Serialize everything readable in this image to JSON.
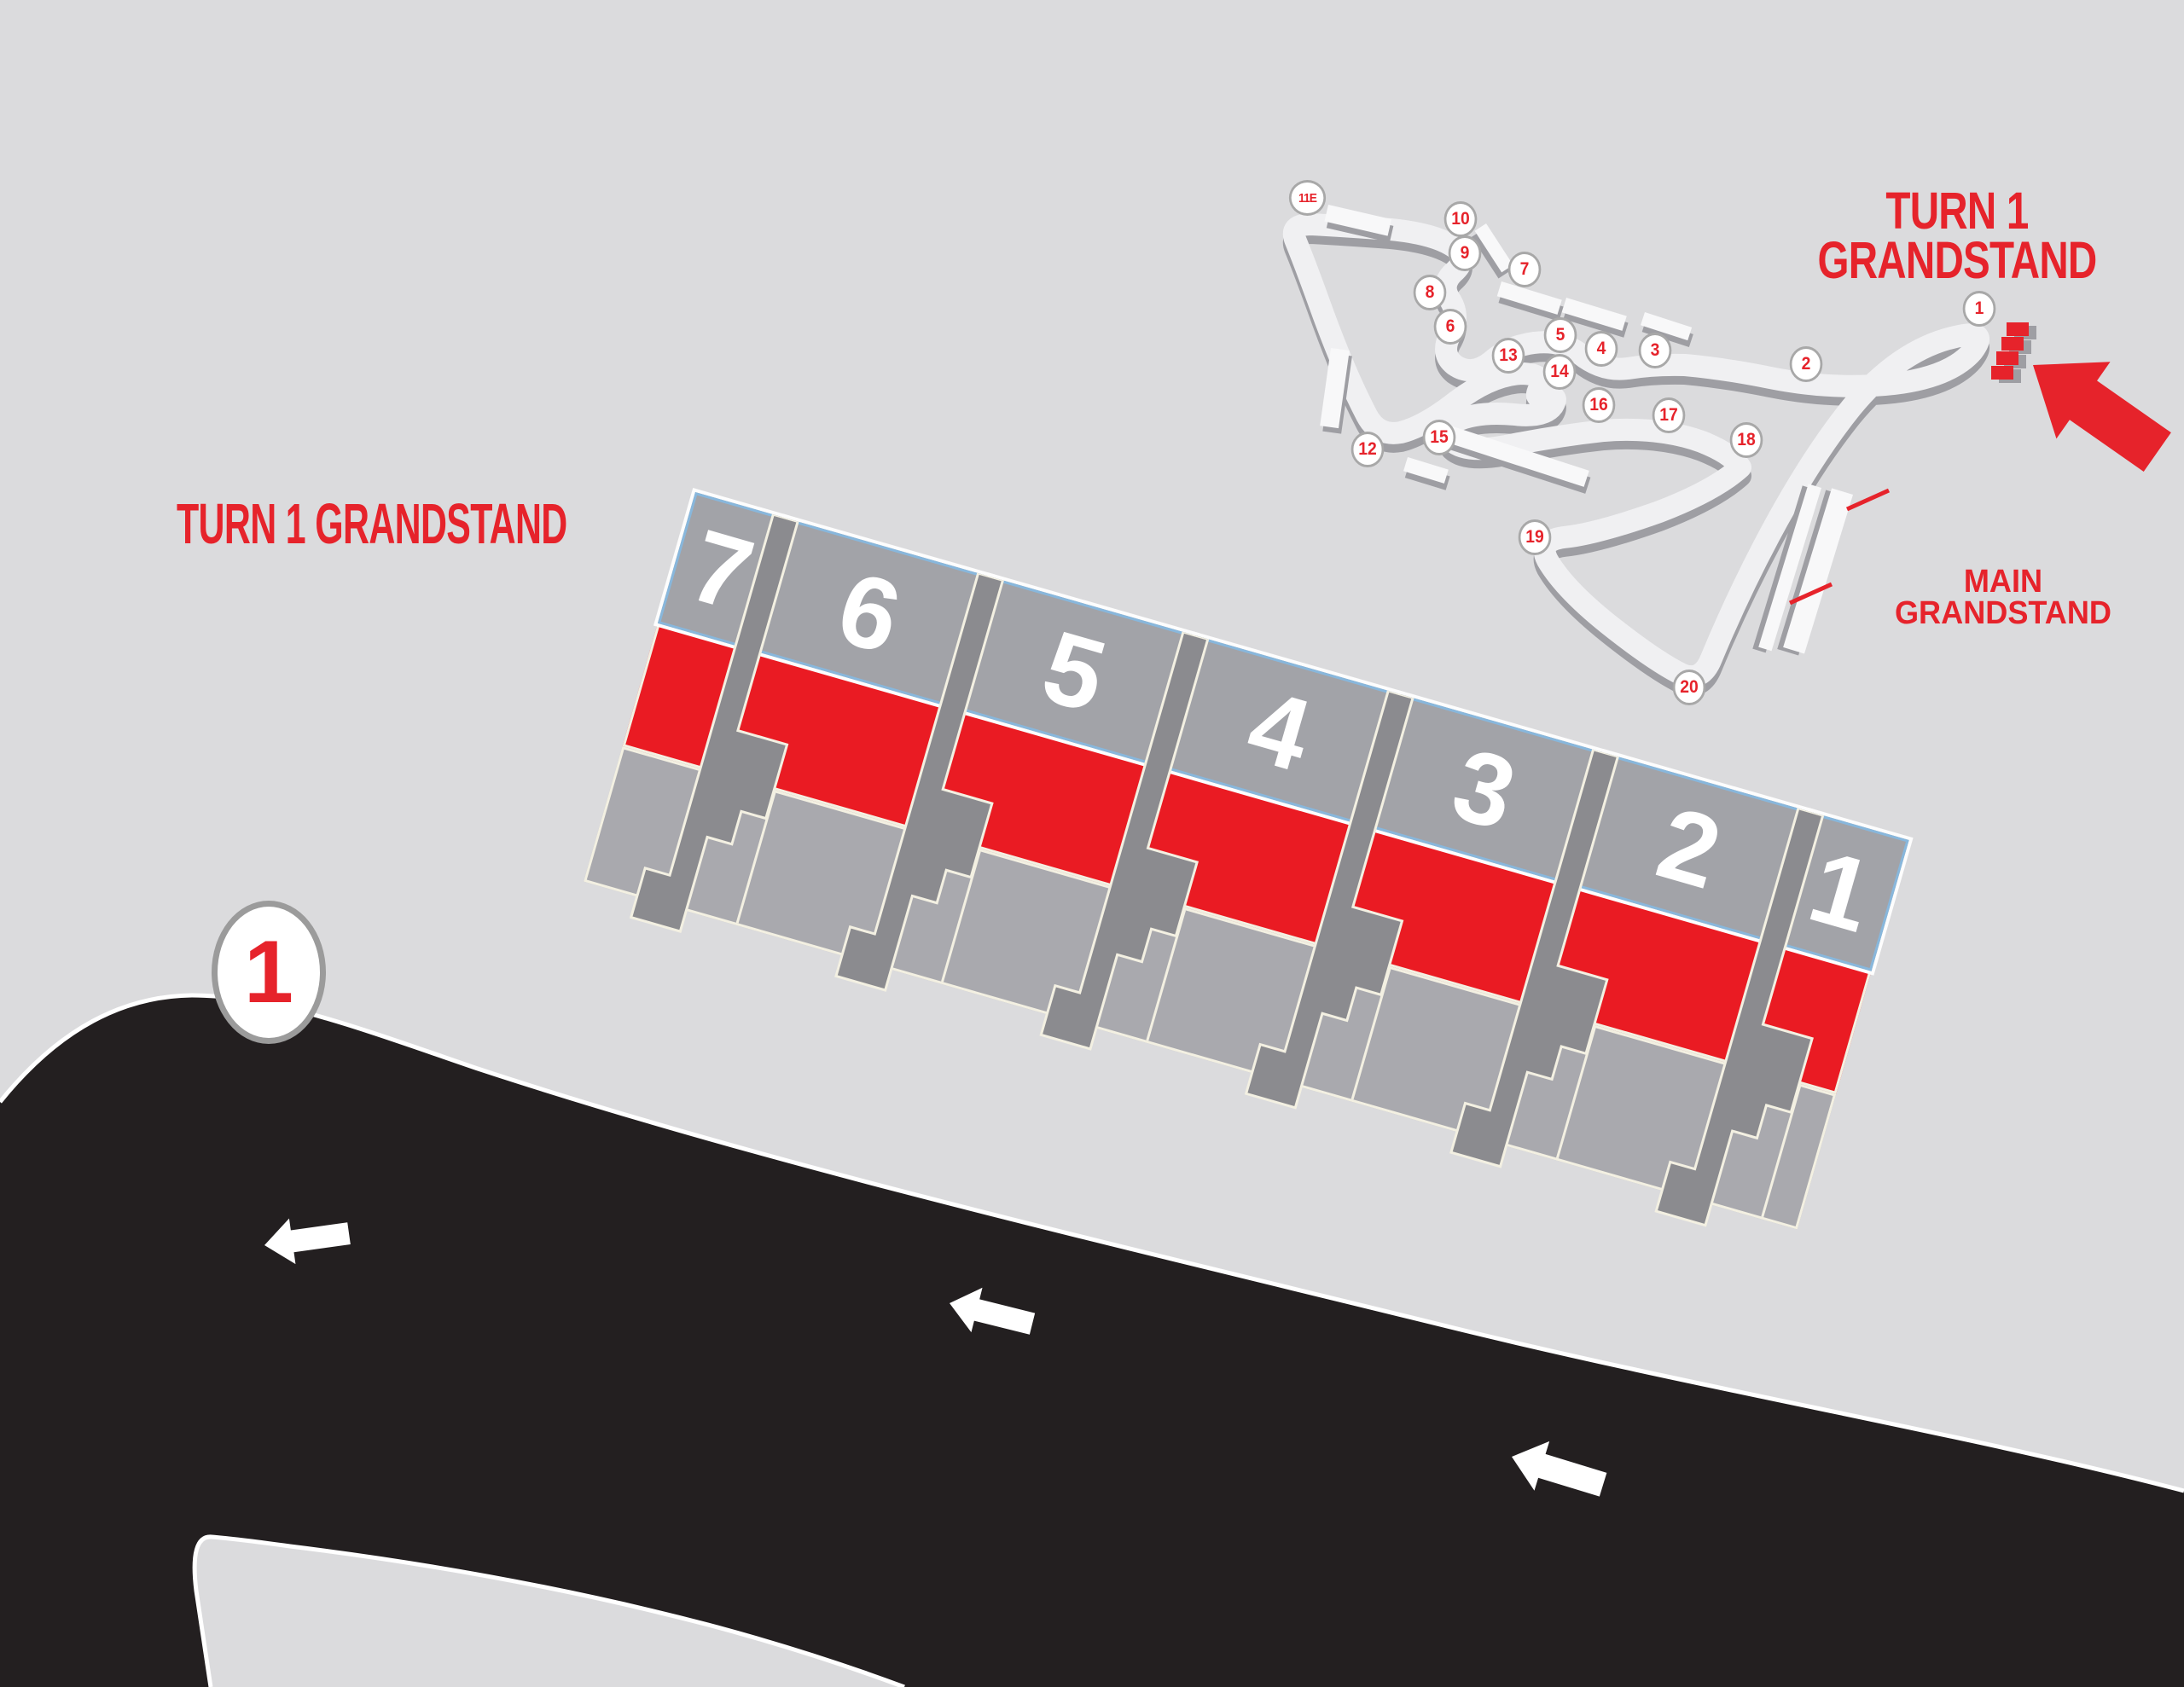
{
  "title": "Turn 1 Grandstand seating map",
  "colors": {
    "background": "#dbdbdd",
    "accent_red": "#e6232b",
    "section_red": "#ea1b23",
    "track_black": "#231f20",
    "panel_gray": "#a2a3a8",
    "lower_gray": "#a9a9ae",
    "walkway_gray": "#8b8b8f",
    "panel_border_blue": "#88b7dc",
    "outline_cream": "#f3f0e2",
    "ribbon_light": "#f0f0f2",
    "ribbon_shadow": "#9e9ea3",
    "marker_ring_gray": "#a8a8a8",
    "white": "#ffffff"
  },
  "headline": "TURN 1 GRANDSTAND",
  "grandstand": {
    "sections": [
      {
        "number": "7"
      },
      {
        "number": "6"
      },
      {
        "number": "5"
      },
      {
        "number": "4"
      },
      {
        "number": "3"
      },
      {
        "number": "2"
      },
      {
        "number": "1"
      }
    ]
  },
  "corner_marker": {
    "label": "1"
  },
  "track_map": {
    "callout": {
      "line1": "TURN 1",
      "line2": "GRANDSTAND"
    },
    "main_grandstand_label": {
      "line1": "MAIN",
      "line2": "GRANDSTAND"
    },
    "turn_markers": [
      {
        "label": "11E"
      },
      {
        "label": "10"
      },
      {
        "label": "9"
      },
      {
        "label": "7"
      },
      {
        "label": "8"
      },
      {
        "label": "6"
      },
      {
        "label": "5"
      },
      {
        "label": "4"
      },
      {
        "label": "3"
      },
      {
        "label": "13"
      },
      {
        "label": "14"
      },
      {
        "label": "2"
      },
      {
        "label": "1"
      },
      {
        "label": "16"
      },
      {
        "label": "17"
      },
      {
        "label": "15"
      },
      {
        "label": "12"
      },
      {
        "label": "18"
      },
      {
        "label": "19"
      },
      {
        "label": "20"
      }
    ]
  }
}
